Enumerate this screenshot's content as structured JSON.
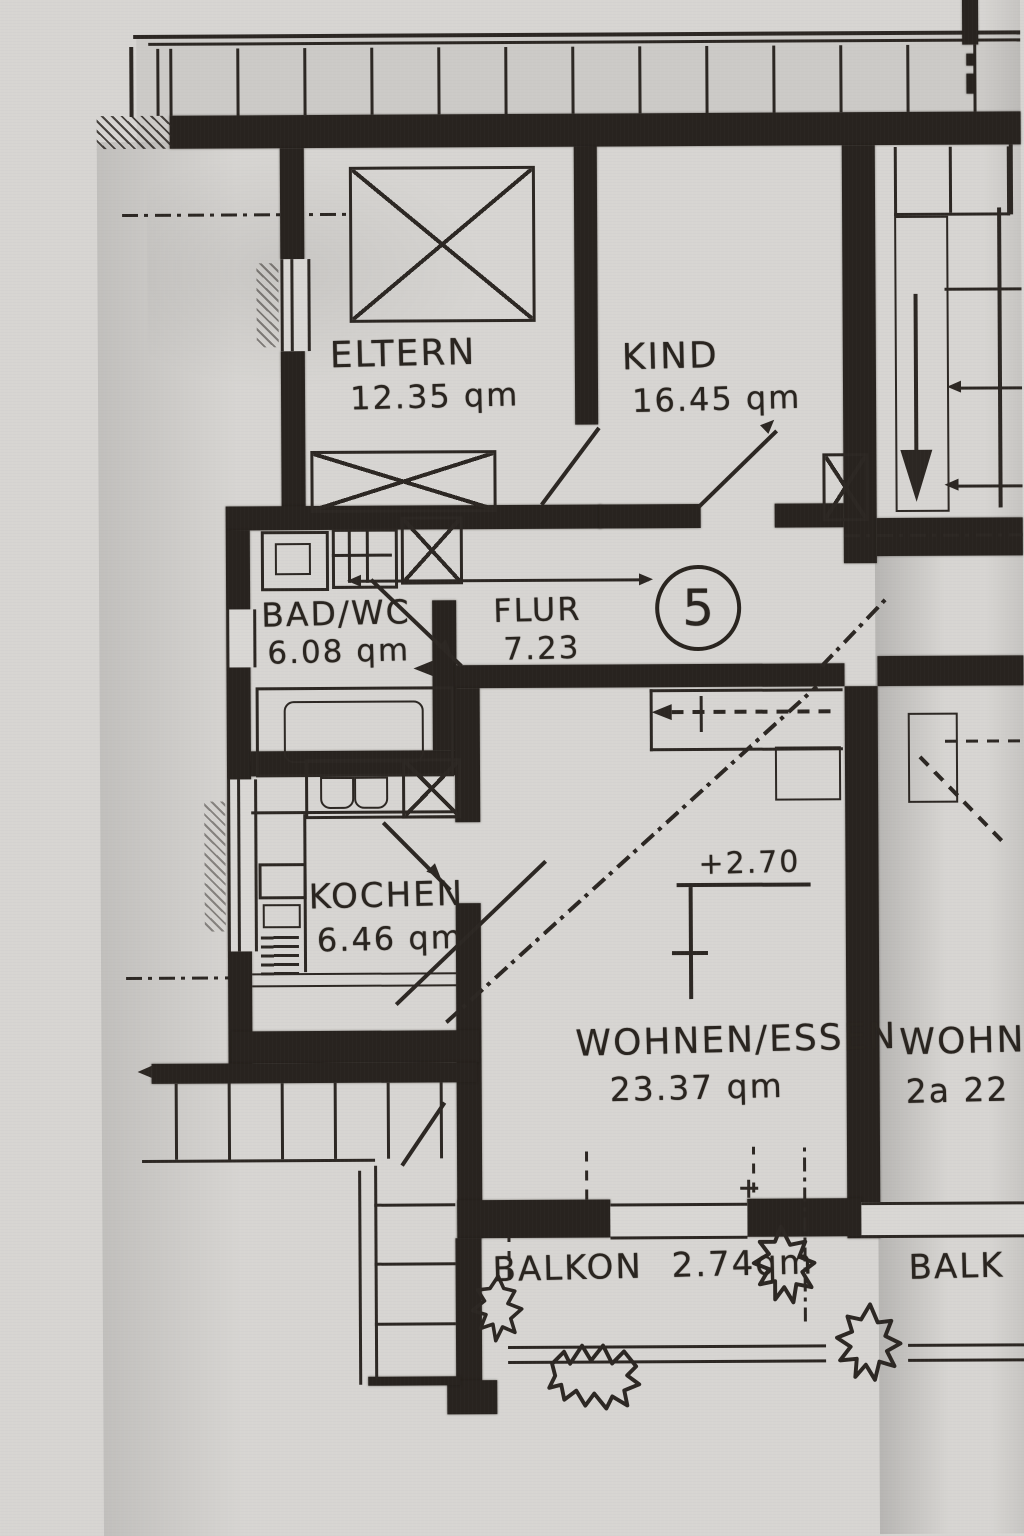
{
  "plan": {
    "unit_number": "5",
    "level_annotation": "+2.70",
    "rooms": [
      {
        "name": "ELTERN",
        "area": "12.35 qm"
      },
      {
        "name": "KIND",
        "area": "16.45 qm"
      },
      {
        "name": "BAD/WC",
        "area": "6.08 qm"
      },
      {
        "name": "FLUR",
        "area": "7.23"
      },
      {
        "name": "KOCHEN",
        "area": "6.46 qm"
      },
      {
        "name": "WOHNEN/ESSEN",
        "area": "23.37 qm"
      },
      {
        "name": "BALKON",
        "area": "2.74qm"
      }
    ],
    "neighbor_labels": {
      "wohnen_partial": "WOHNE",
      "area_partial": "2a 22",
      "balkon_partial": "BALK"
    },
    "ink_color": "#2c2723",
    "paper_color": "#d7d5d2"
  }
}
